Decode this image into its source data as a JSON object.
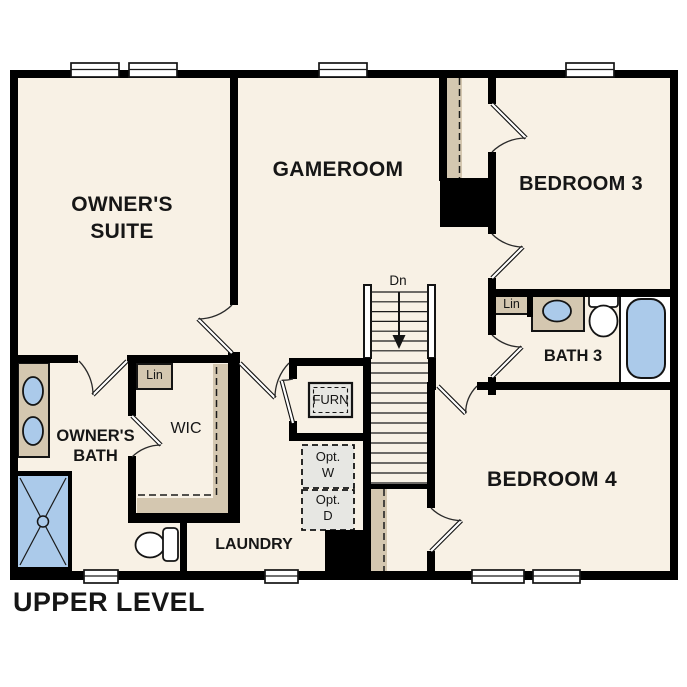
{
  "plan": {
    "title": "UPPER LEVEL",
    "rooms": {
      "owners_suite_line1": "OWNER'S",
      "owners_suite_line2": "SUITE",
      "gameroom": "GAMEROOM",
      "bedroom3": "BEDROOM 3",
      "bath3": "BATH 3",
      "bedroom4": "BEDROOM 4",
      "owners_bath_line1": "OWNER'S",
      "owners_bath_line2": "BATH",
      "wic": "WIC",
      "laundry": "LAUNDRY"
    },
    "annotations": {
      "stairs_direction": "Dn",
      "furnace": "FURN",
      "linen_wic": "Lin",
      "linen_bath3": "Lin",
      "optional_washer_line1": "Opt.",
      "optional_washer_line2": "W",
      "optional_dryer_line1": "Opt.",
      "optional_dryer_line2": "D"
    },
    "colors": {
      "wall": "#000000",
      "floor": "#f8f1e5",
      "casework_tan": "#d4c7b0",
      "fixture_blue": "#abcaea",
      "equipment_gray": "#e7e7e3",
      "background": "#ffffff",
      "text": "#161616"
    }
  }
}
